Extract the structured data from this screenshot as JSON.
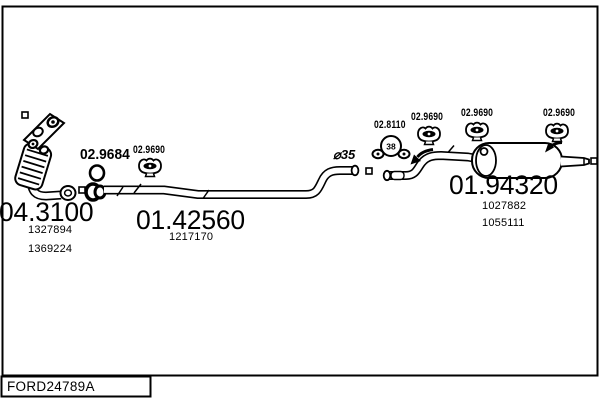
{
  "diagram": {
    "drawing_code": "FORD24789A",
    "sections": {
      "catalyst": {
        "code": "04.3100",
        "oe_refs": [
          "1327894",
          "1369224"
        ]
      },
      "mid_pipe": {
        "code": "01.42560",
        "oe_refs": [
          "1217170"
        ]
      },
      "rear_muffler": {
        "code": "01.94320",
        "oe_refs": [
          "1027882",
          "1055111"
        ]
      }
    },
    "mountings": {
      "gasket_code": "02.9684",
      "clamp_code": "02.8110",
      "clamp_size": "38",
      "hanger_codes": [
        "02.9690",
        "02.9690",
        "02.9690",
        "02.9690"
      ],
      "pipe_diameter": "⌀35"
    },
    "colors": {
      "ink": "#000000",
      "paper": "#ffffff"
    }
  }
}
